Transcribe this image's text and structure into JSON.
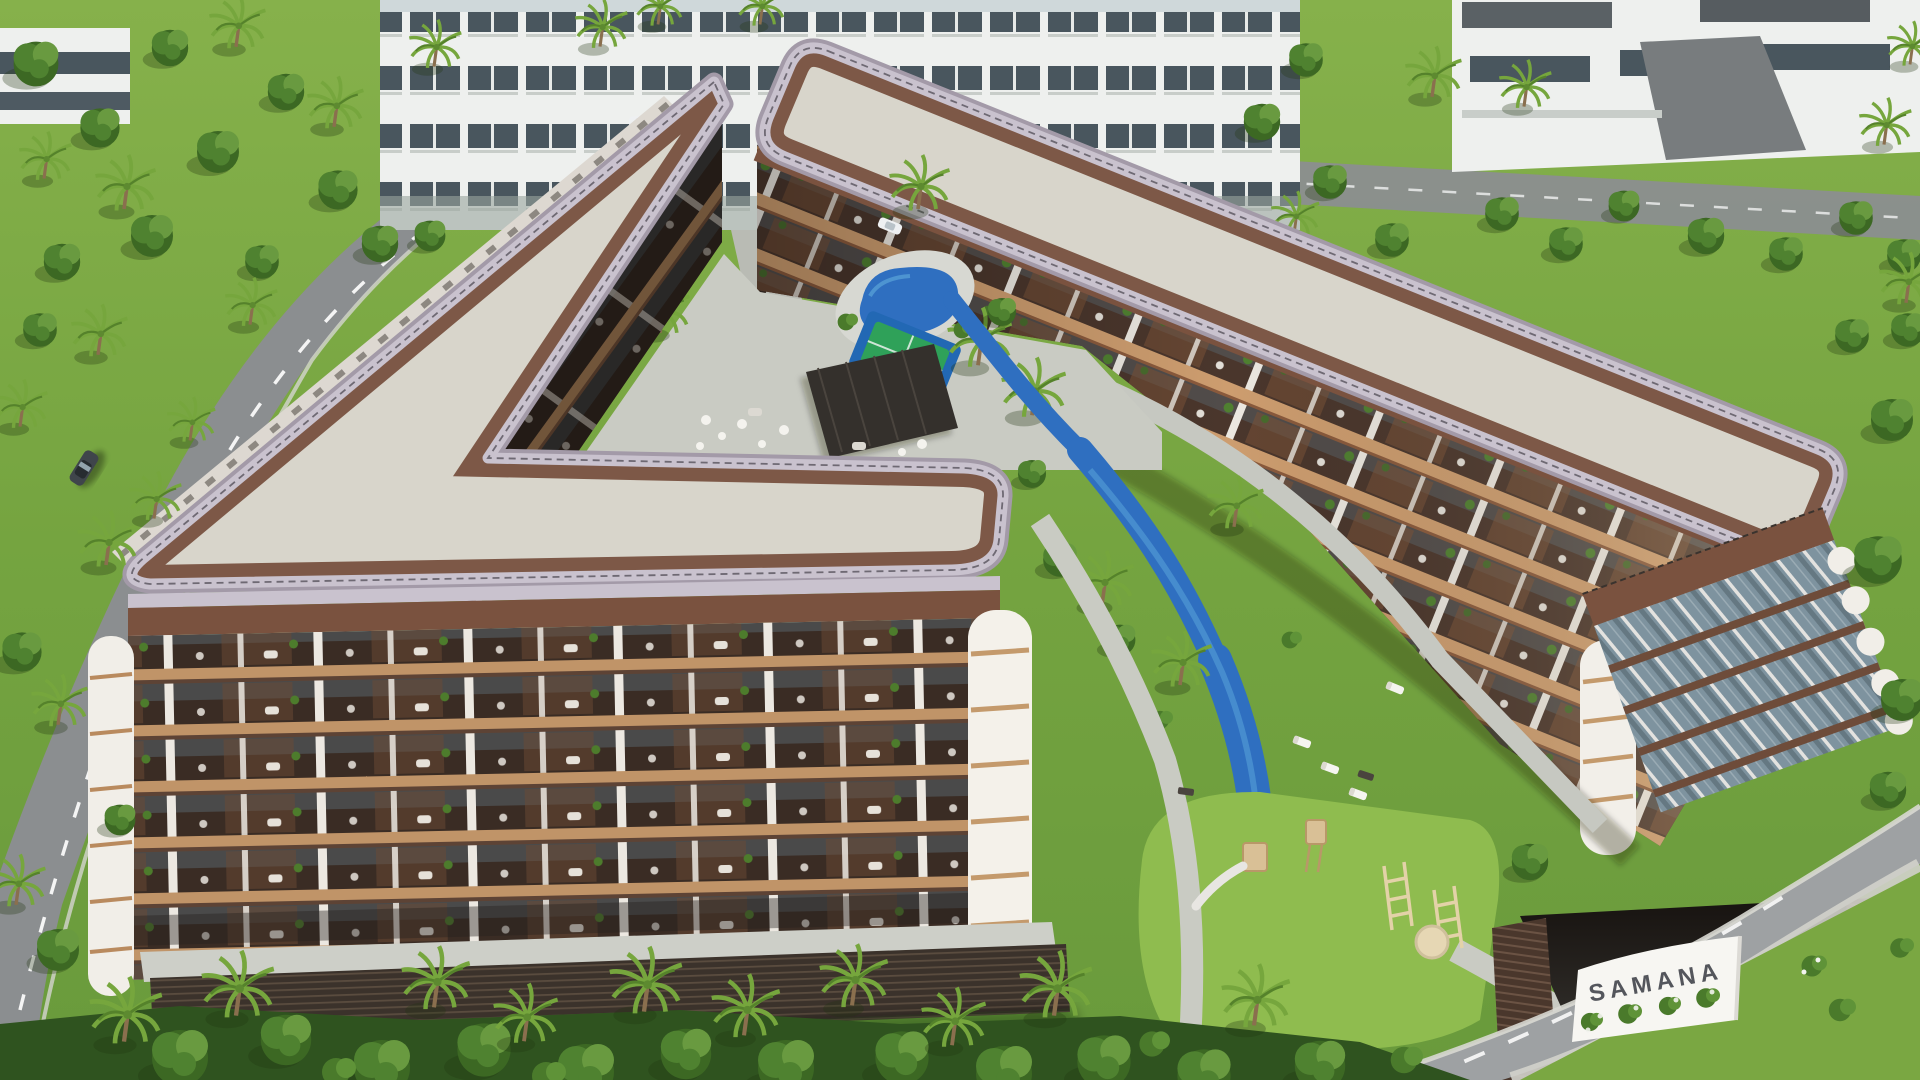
{
  "sign": {
    "text": "SAMANA"
  },
  "entities": [
    "v-shaped-apartment-building",
    "bar-apartment-building",
    "flat-roof-decks",
    "balcony-facades",
    "courtyard-pool",
    "lazy-river",
    "paddle-court",
    "pergola-lounge",
    "children-playground",
    "entrance-gate-sign",
    "perimeter-road",
    "suv-car",
    "white-cars",
    "palm-trees",
    "background-villas"
  ],
  "colors": {
    "roofDeck": "#d8d5cb",
    "roofDeckShade": "#c9c6bb",
    "parapet": "#c9c2ce",
    "parapetShade": "#a39aa8",
    "fascia": "#7a523f",
    "roofBand": "#7d5847",
    "facadeWhite": "#f0ede7",
    "slab": "#c09468",
    "slabSun": "#cd9d6f",
    "opening": "#3a2c24",
    "openingWarm": "#6b4a33",
    "column": "#ece8e1",
    "glass": "#7e939f",
    "lawn": "#7aa742",
    "lawnLight": "#8fbc4f",
    "treeDark": "#3c6823",
    "tree": "#4f8230",
    "treeLight": "#699a40",
    "palm": "#76a63d",
    "road": "#8b8e90",
    "roadLight": "#9ea1a3",
    "path": "#c9cbc3",
    "water": "#2f6fc0",
    "waterLight": "#5aa4d8",
    "court": "#2fa159",
    "courtBlue": "#2268b4",
    "wood": "#d9c096",
    "woodDark": "#b89868",
    "pergola": "#34302c",
    "podium": "#3b322b",
    "sign": "#f7f6f2",
    "signText": "#54565c",
    "carBody": "#3f454b",
    "carWhite": "#eef0f2"
  }
}
